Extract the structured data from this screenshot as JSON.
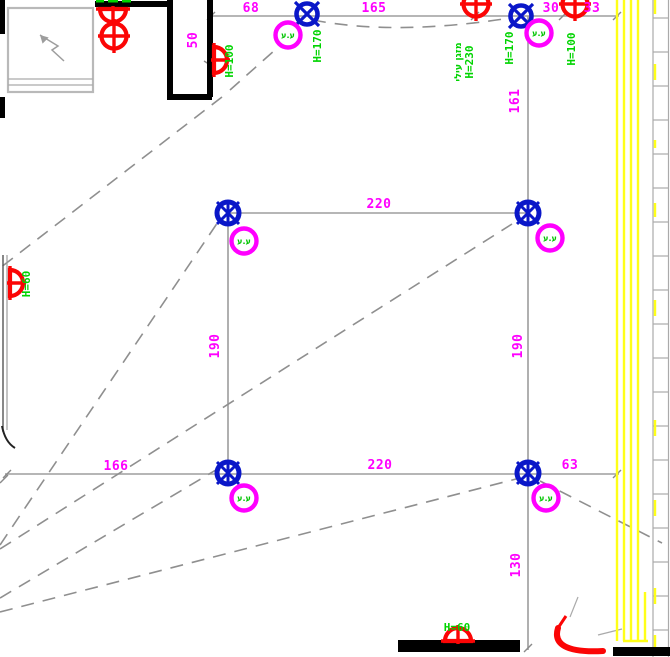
{
  "colors": {
    "wall_black": "#000000",
    "construction_gray": "#9d9d9d",
    "dashed_gray": "#8f8f8f",
    "dimension_magenta": "#ff00ff",
    "height_green": "#00d400",
    "fixture_red": "#fb0505",
    "fixture_blue": "#0a17c8",
    "hatch_yellow": "#ffff18",
    "window_gray": "#b9b9b9"
  },
  "dimensions": {
    "top": {
      "d68": "68",
      "d165": "165",
      "d30": "30",
      "d33": "33"
    },
    "vertical": {
      "d50": "50",
      "d161": "161",
      "d190_left": "190",
      "d190_right": "190",
      "d130": "130"
    },
    "square": {
      "top": "220",
      "bottom": "220"
    },
    "bottom": {
      "d166": "166",
      "d63": "63"
    }
  },
  "heights": {
    "h100_left": "H=100",
    "h170_left": "H=170",
    "ac_label": "מזגן עילי",
    "h230": "H=230",
    "h170_right": "H=170",
    "h100_right": "H=100",
    "h60_left": "H=60",
    "h60_bottom": "H=60"
  },
  "junction_label": "ע.ע"
}
